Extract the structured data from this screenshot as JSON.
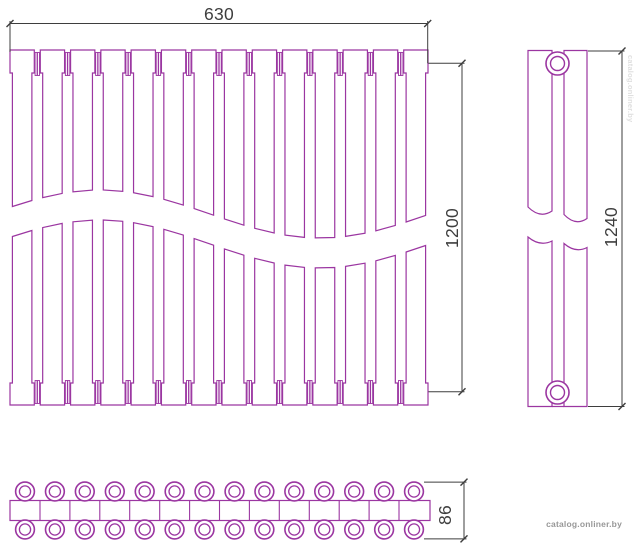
{
  "drawing": {
    "type": "radiator-technical-drawing",
    "outline_color": "#9b36a1",
    "dimension_color": "#3e3e3e",
    "background_color": "#ffffff",
    "views": {
      "front": {
        "label": "front-view",
        "sections": 14,
        "connectors": 13,
        "has_break_wave": true
      },
      "side": {
        "label": "side-view",
        "bars": 2,
        "collector_circles": 2,
        "has_break_wave": true
      },
      "top": {
        "label": "top-view",
        "tube_columns": 14,
        "tube_rows": 2
      }
    },
    "dimensions": {
      "width": "630",
      "height": "1200",
      "side_height": "1240",
      "depth": "86"
    }
  },
  "watermark": {
    "text": "catalog.onliner.by"
  }
}
